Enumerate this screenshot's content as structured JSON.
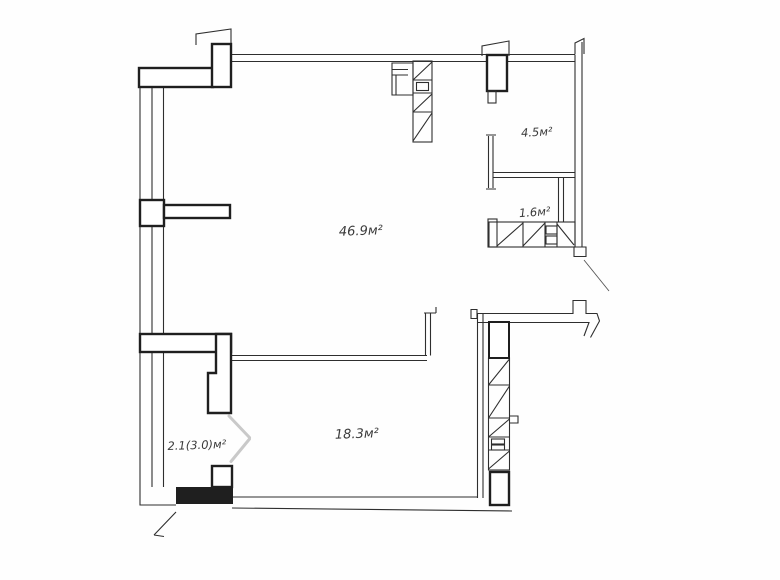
{
  "rooms": [
    {
      "id": "main-room",
      "area_label": "46.9м²"
    },
    {
      "id": "room-top-right",
      "area_label": "4.5м²"
    },
    {
      "id": "room-right-small",
      "area_label": "1.6м²"
    },
    {
      "id": "room-bottom",
      "area_label": "18.3м²"
    },
    {
      "id": "balcony",
      "area_label": "2.1(3.0)м²"
    }
  ],
  "colors": {
    "line": "#2e2e2e",
    "background": "#ffffff",
    "door_swing": "#c9c9c9"
  }
}
